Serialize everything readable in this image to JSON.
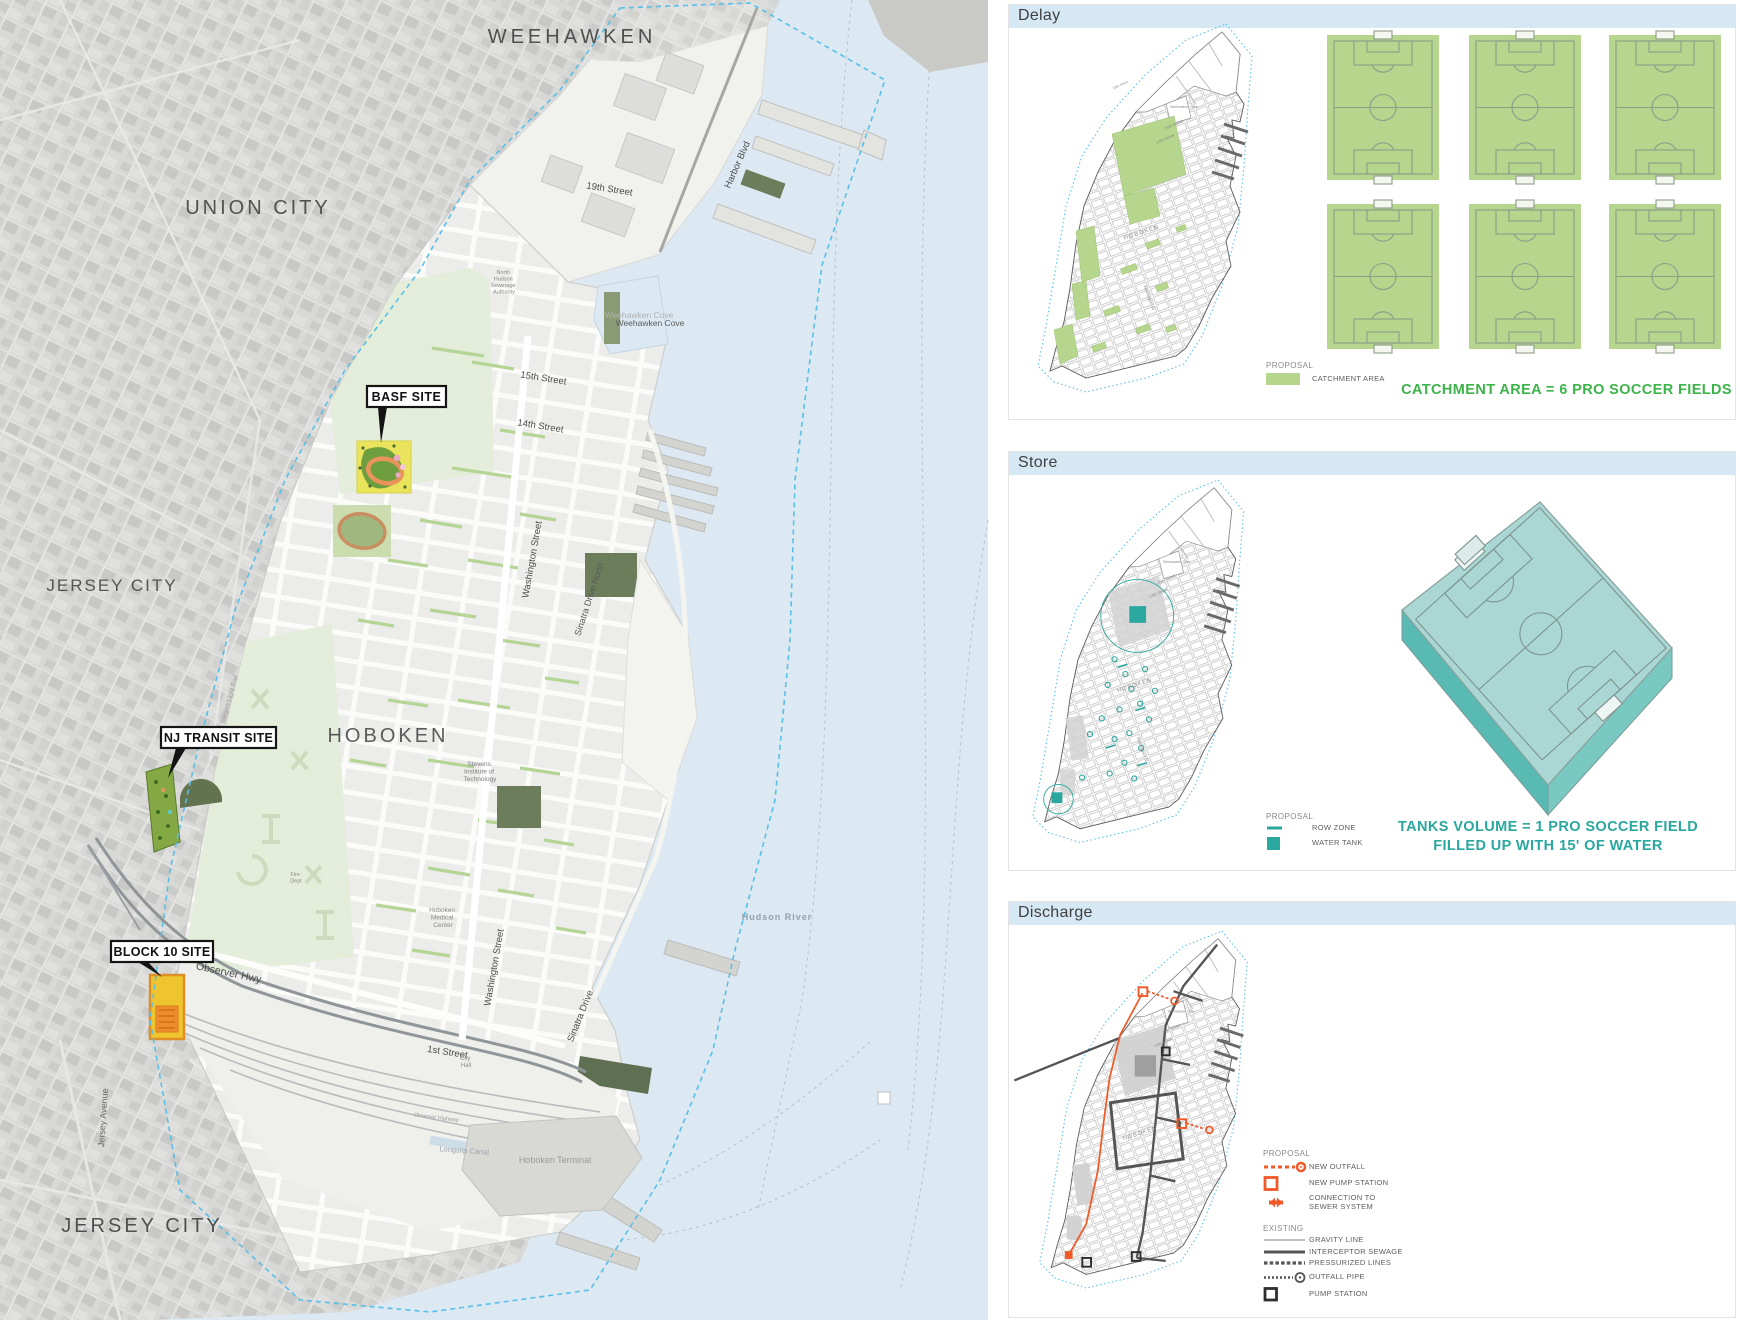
{
  "map": {
    "regions": {
      "weehawken": "WEEHAWKEN",
      "union_city": "UNION CITY",
      "jersey_city_upper": "JERSEY CITY",
      "hoboken": "HOBOKEN",
      "jersey_city_lower": "JERSEY CITY"
    },
    "water": {
      "hudson_river": "Hudson River",
      "weehawken_cove": "Weehawken Cove"
    },
    "streets": {
      "street_19th": "19th Street",
      "harbor_blvd": "Harbor Blvd",
      "street_15th": "15th Street",
      "street_14th": "14th Street",
      "washington_north": "Washington Street",
      "sinatra_drive_north": "Sinatra Drive North",
      "washington_south": "Washington Street",
      "sinatra_drive": "Sinatra Drive",
      "street_1st": "1st Street",
      "observer_hwy": "Observer Hwy",
      "observer_highway_small": "Observer Highway",
      "jersey_avenue": "Jersey Avenue",
      "longslip_canal": "Longslip Canal",
      "bergen_light_rail": "Bergen Light Rail"
    },
    "places": {
      "nhsa": [
        "North",
        "Hudson",
        "Sewerage",
        "Authority"
      ],
      "stevens": [
        "Stevens",
        "Institute of",
        "Technology"
      ],
      "medical": [
        "Hoboken",
        "Medical",
        "Center"
      ],
      "city_hall": [
        "City",
        "Hall"
      ],
      "fire_dept": [
        "Fire",
        "Dept"
      ],
      "hoboken_terminal": "Hoboken Terminal"
    },
    "sites": {
      "basf": "BASF SITE",
      "nj_transit": "NJ TRANSIT SITE",
      "block10": "BLOCK 10 SITE"
    }
  },
  "minimap": {
    "hoboken": "HOBOKEN",
    "street_15th": "15th Street",
    "street_14th": "14th Street",
    "washington": "Washington St",
    "cove": "Weehawken Cove"
  },
  "panels": {
    "delay": {
      "title": "Delay",
      "legend_title": "PROPOSAL",
      "legend_item": "CATCHMENT AREA",
      "headline": "CATCHMENT AREA = 6 PRO SOCCER FIELDS",
      "soccer_field_count": 6
    },
    "store": {
      "title": "Store",
      "legend_title": "PROPOSAL",
      "legend_items": [
        "ROW ZONE",
        "WATER TANK"
      ],
      "headline_line1": "TANKS VOLUME = 1 PRO SOCCER FIELD",
      "headline_line2": "FILLED UP WITH 15' OF WATER"
    },
    "discharge": {
      "title": "Discharge",
      "proposal_title": "PROPOSAL",
      "proposal_items": [
        "NEW OUTFALL",
        "NEW PUMP STATION",
        "CONNECTION TO",
        "SEWER SYSTEM"
      ],
      "existing_title": "EXISTING",
      "existing_items": [
        "GRAVITY LINE",
        "INTERCEPTOR SEWAGE",
        "PRESSURIZED LINES",
        "OUTFALL PIPE",
        "PUMP STATION"
      ]
    }
  },
  "colors": {
    "accent_green": "#3cb44a",
    "catchment_green": "#b5d68c",
    "accent_teal": "#2aa79e",
    "tank_top_teal": "#aad7d3",
    "accent_orange": "#f05a28",
    "panel_header_blue": "#d5e8f4",
    "water_blue": "#dce9f2",
    "boundary_blue": "#57bfe9"
  }
}
